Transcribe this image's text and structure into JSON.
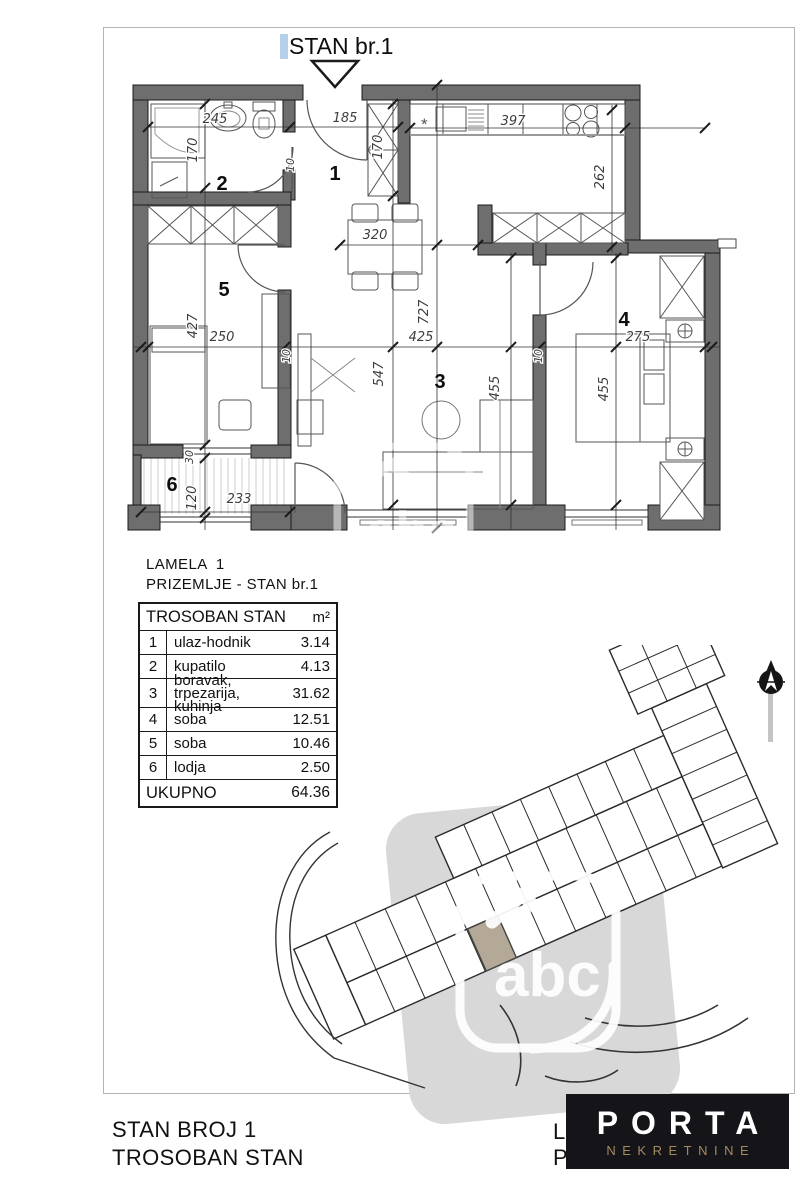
{
  "title": "STAN br.1",
  "plan": {
    "rooms": [
      "1",
      "2",
      "3",
      "4",
      "5",
      "6"
    ],
    "dims": {
      "bath_w": "245",
      "bath_h": "170",
      "entry_w": "185",
      "entry_t": "10",
      "hall_c": "170",
      "kitchen_w": "397",
      "kitchen_h": "262",
      "dining_w": "320",
      "living_h": "727",
      "living_w": "425",
      "living_v": "547",
      "r5_w": "250",
      "r5_h": "427",
      "win30": "30",
      "lodja_h": "120",
      "lodja_w": "233",
      "r3_v": "455",
      "r4_v": "455",
      "r4_w": "275",
      "t10a": "10",
      "t10b": "10"
    },
    "kitchen_star": "*"
  },
  "caption": {
    "line1": "LAMELA  1",
    "line2": "PRIZEMLJE - STAN br.1"
  },
  "table": {
    "header": {
      "name": "TROSOBAN STAN",
      "unit": "m²"
    },
    "rows": [
      {
        "no": "1",
        "name": "ulaz-hodnik",
        "area": "3.14"
      },
      {
        "no": "2",
        "name": "kupatilo",
        "area": "4.13"
      },
      {
        "no": "3",
        "name": "boravak, trpezarija, kuhinja",
        "area": "31.62"
      },
      {
        "no": "4",
        "name": "soba",
        "area": "12.51"
      },
      {
        "no": "5",
        "name": "soba",
        "area": "10.46"
      },
      {
        "no": "6",
        "name": "lodja",
        "area": "2.50"
      }
    ],
    "total": {
      "label": "UKUPNO",
      "value": "64.36"
    }
  },
  "watermark": {
    "text": "abc"
  },
  "footer": {
    "line1": "STAN BROJ 1",
    "line2": "TROSOBAN STAN",
    "hidden1": "L",
    "hidden2": "P",
    "logo": {
      "name": "PORTA",
      "subtitle": "NEKRETNINE"
    }
  },
  "colors": {
    "wall": "#6e6e6e",
    "highlight_unit": "#b3a996",
    "logo_bg": "#141419",
    "logo_gold": "#a38b5f",
    "selection": "#b5d0ea",
    "gray_band": "#d8d8d8"
  }
}
